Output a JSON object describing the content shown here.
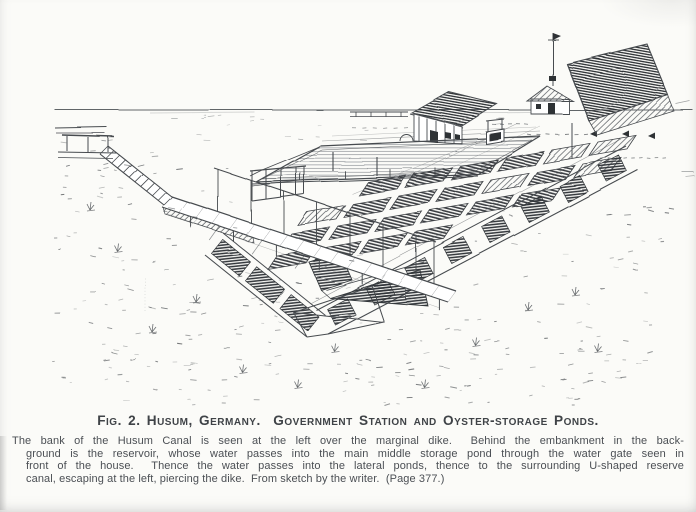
{
  "palette": {
    "page_bg": "#fbfbf8",
    "ink": "#474b4f",
    "ink_light": "#81868a",
    "ink_dark": "#2e3236",
    "title_ink": "#3f4347",
    "caption_ink": "#4b4f54"
  },
  "figure": {
    "title": "Fig. 2. Husum, Germany.  Government Station and Oyster-storage Ponds.",
    "caption_lines": [
      "The bank of the Husum Canal is seen at the left over the marginal dike.  Behind the embankment in the back-",
      "ground is the reservoir, whose water passes into the main middle storage pond through the water gate seen in",
      "front of the house.  Thence the water passes into the lateral ponds, thence to the surrounding U-shaped reserve",
      "canal, escaping at the left, piercing the dike.  From sketch by the writer.  (Page 377.)"
    ]
  }
}
